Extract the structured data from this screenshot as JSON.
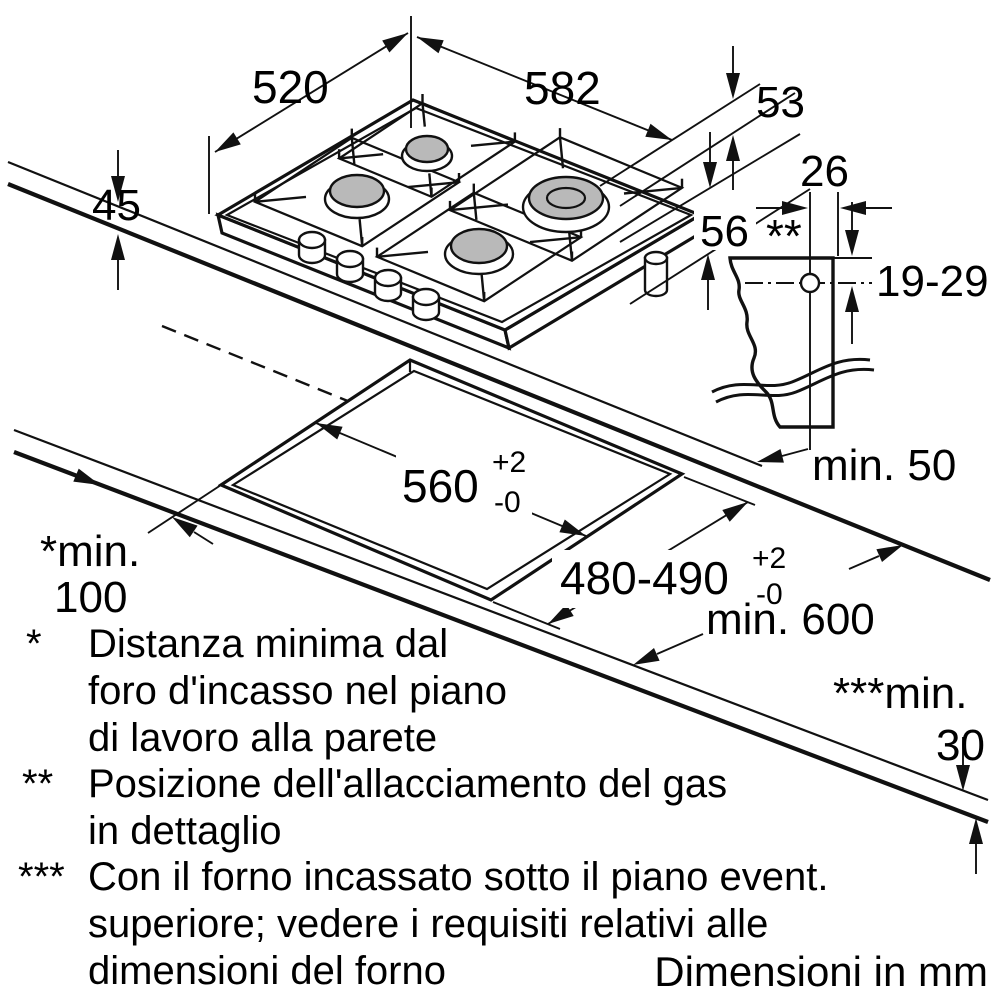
{
  "dims": {
    "hob_width": "582",
    "hob_depth": "520",
    "hob_height": "45",
    "edge": "53",
    "under": "56",
    "gas_offset": "26",
    "gas_marker": "**",
    "gas_range": "19-29",
    "cut_width": "560",
    "cut_width_plus": "+2",
    "cut_width_minus": "-0",
    "cut_depth": "480-490",
    "cut_depth_plus": "+2",
    "cut_depth_minus": "-0",
    "wall_clearance": "min. 50",
    "front_min_1": "*min.",
    "front_min_2": "100",
    "worktop_min": "min. 600",
    "under_min_1": "***min.",
    "under_min_2": "30"
  },
  "footnotes": [
    {
      "mark": "*",
      "lines": [
        "Distanza minima dal",
        "foro d'incasso nel piano",
        "di lavoro alla parete"
      ]
    },
    {
      "mark": "**",
      "lines": [
        "Posizione dell'allacciamento del gas",
        "in dettaglio"
      ]
    },
    {
      "mark": "***",
      "lines": [
        "Con il forno incassato sotto il piano event.",
        "superiore; vedere i requisiti relativi alle",
        "dimensioni del forno"
      ]
    }
  ],
  "footer": "Dimensioni in mm"
}
